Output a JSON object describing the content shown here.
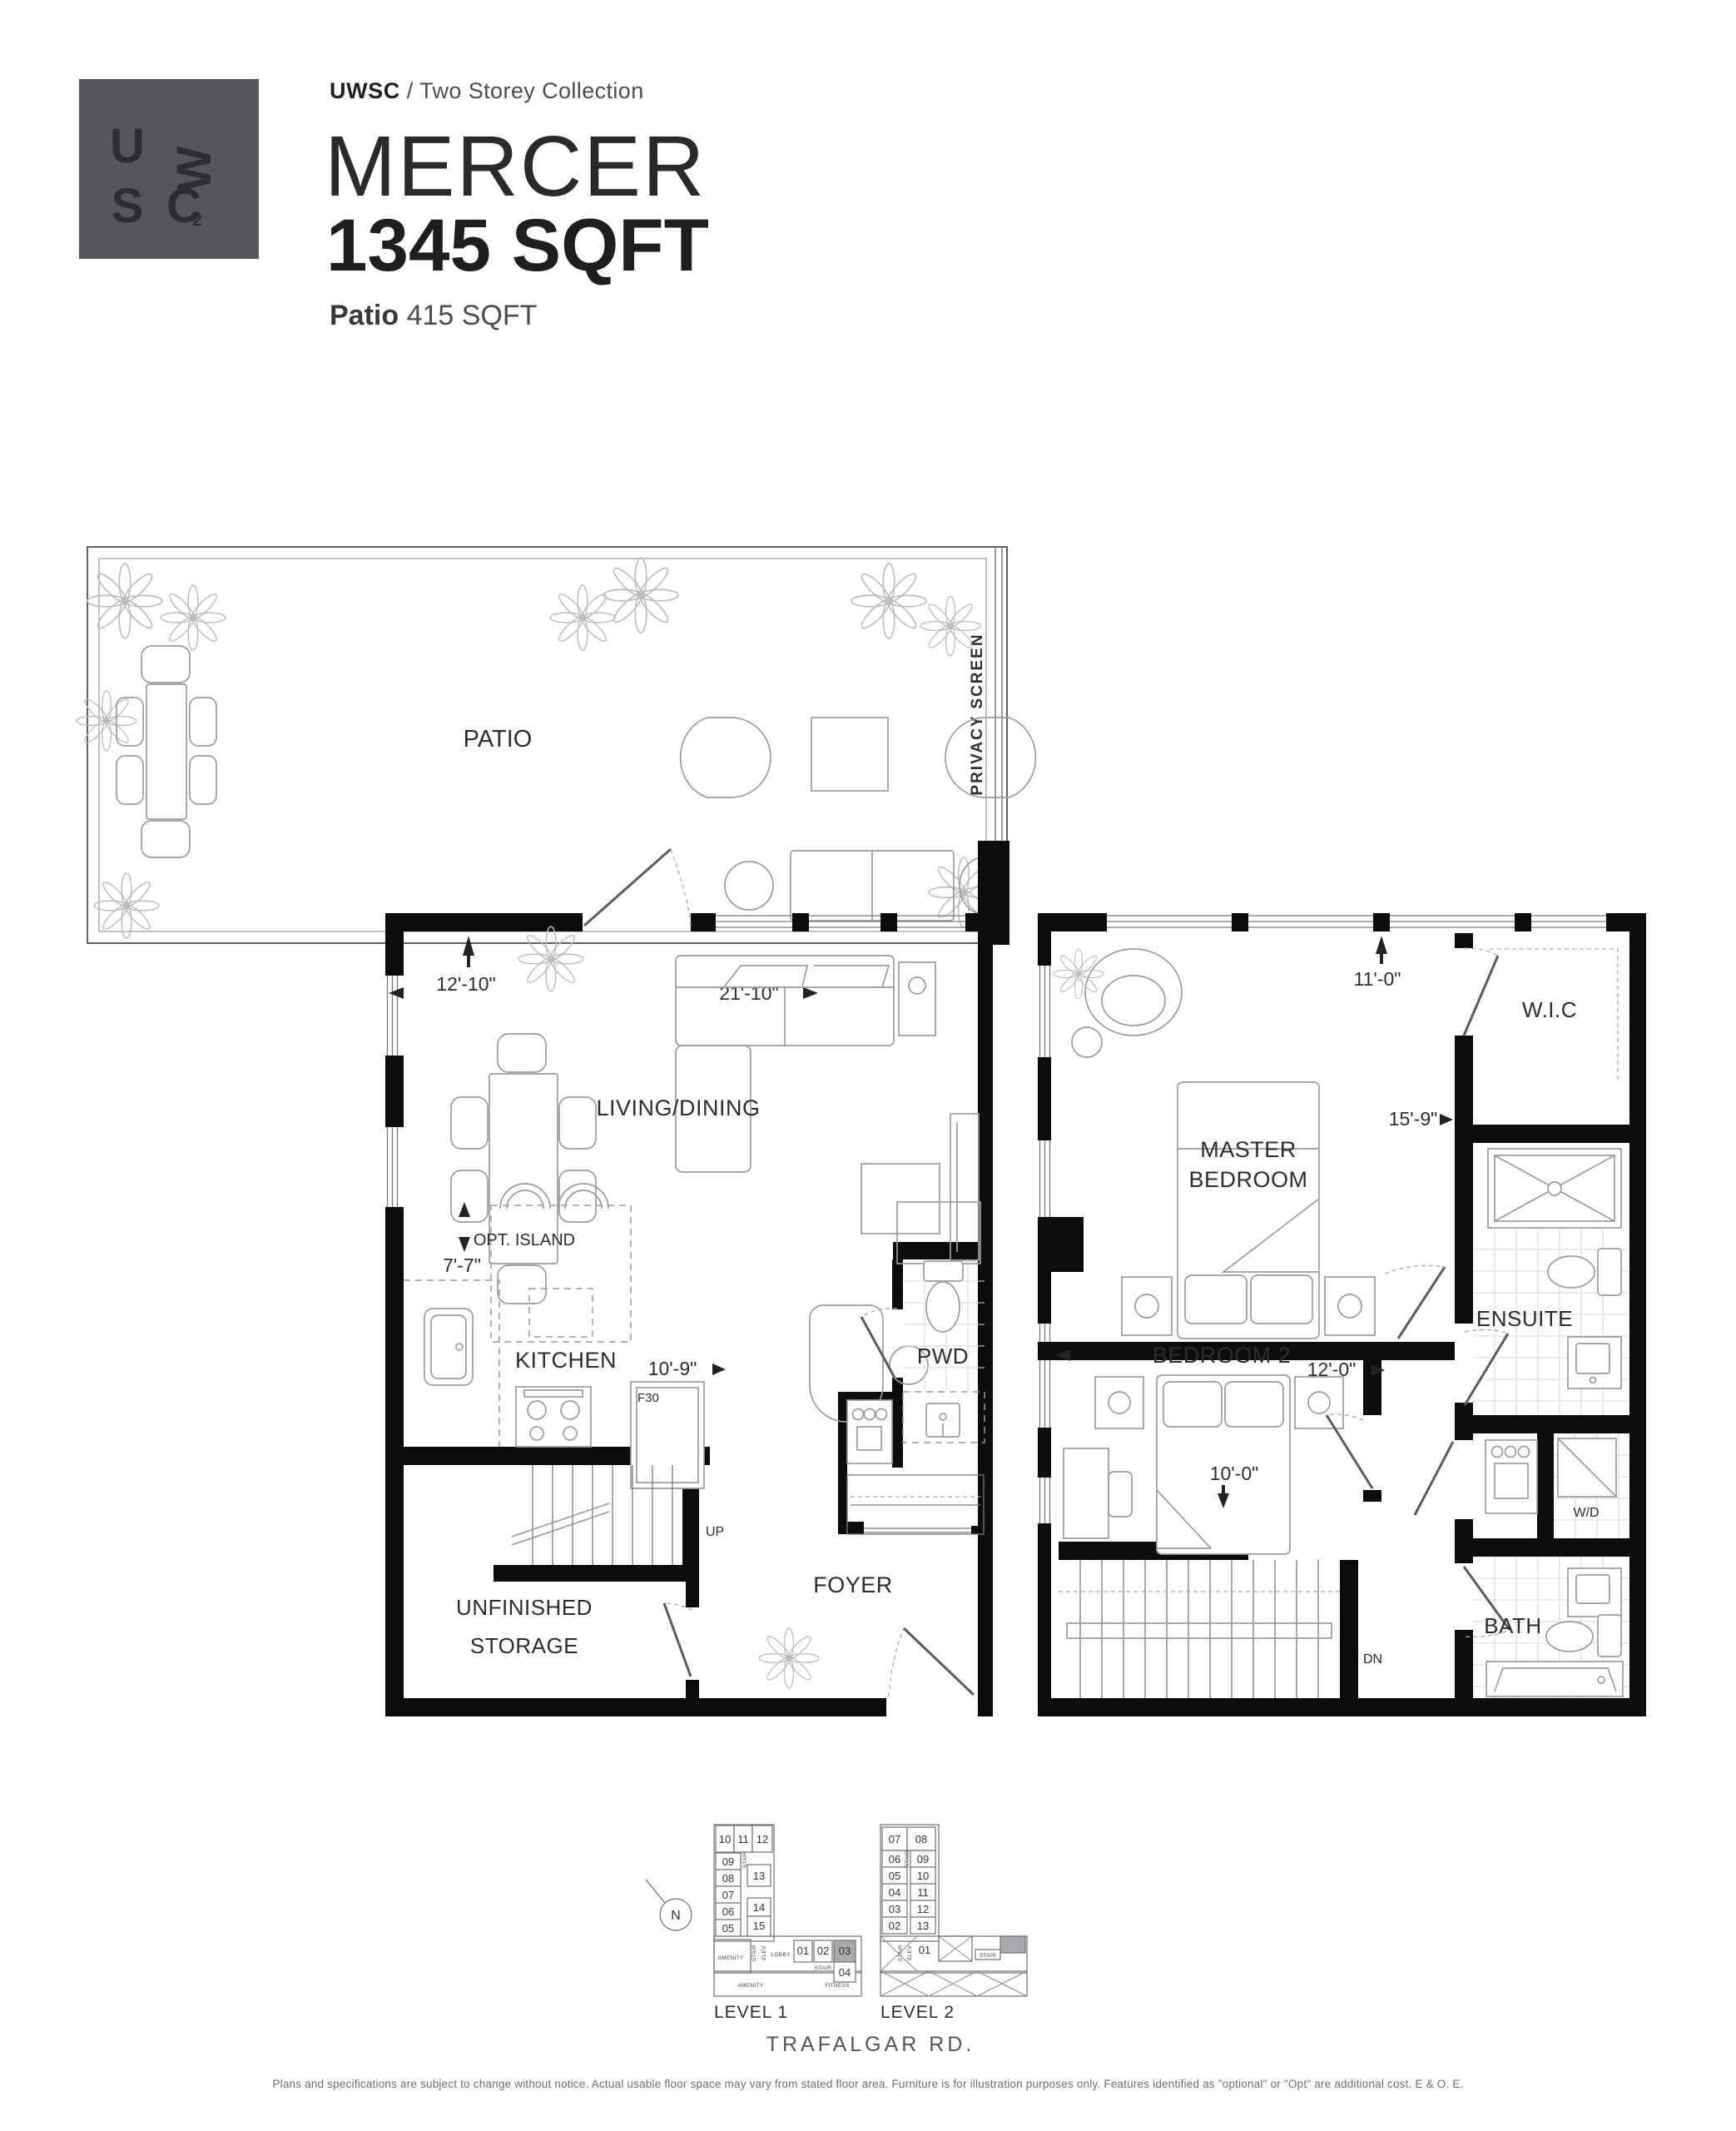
{
  "colors": {
    "logo_bg": "#55565a",
    "wall": "#0c0c0c",
    "highlight": "#a7a9ac",
    "furniture": "#9c9c9c",
    "text": "#2d2d2f",
    "muted": "#6e6e70"
  },
  "header": {
    "brand": "UWSC",
    "separator": "/",
    "collection": "Two Storey Collection",
    "plan_name": "MERCER",
    "plan_area": "1345 SQFT",
    "patio_label": "Patio",
    "patio_area": "415 SQFT"
  },
  "logo": {
    "u": "U",
    "w": "W",
    "s": "S",
    "c": "C",
    "two": "2"
  },
  "l1": {
    "patio": "PATIO",
    "privacy": "PRIVACY SCREEN",
    "living": "LIVING/DINING",
    "kitchen": "KITCHEN",
    "island": "OPT. ISLAND",
    "pwd": "PWD",
    "foyer": "FOYER",
    "storage1": "UNFINISHED",
    "storage2": "STORAGE",
    "up": "UP",
    "fridge": "F30",
    "d_entry": "12'-10\"",
    "d_depth": "21'-10\"",
    "d_kw": "7'-7\"",
    "d_kl": "10'-9\""
  },
  "l2": {
    "master1": "MASTER",
    "master2": "BEDROOM",
    "wic": "W.I.C",
    "ensuite": "ENSUITE",
    "bed2": "BEDROOM 2",
    "bath": "BATH",
    "wd": "W/D",
    "dn": "DN",
    "d_mw": "11'-0\"",
    "d_ml": "15'-9\"",
    "d_b2w": "12'-0\"",
    "d_b2l": "10'-0\""
  },
  "kp": {
    "north": "N",
    "street": "TRAFALGAR RD.",
    "l1": {
      "label": "LEVEL 1",
      "top": [
        "10",
        "11",
        "12"
      ],
      "left": [
        "09",
        "08",
        "07",
        "06",
        "05"
      ],
      "mid": [
        "13",
        "14",
        "15"
      ],
      "row": [
        "01",
        "02",
        "03",
        "04"
      ],
      "stair": "STAIR",
      "elev": "ELEV",
      "amenity": "AMENITY",
      "lobby": "LOBBY",
      "fitness": "FITNESS"
    },
    "l2": {
      "label": "LEVEL 2",
      "top": [
        "07",
        "08"
      ],
      "left": [
        "06",
        "05",
        "04",
        "03",
        "02"
      ],
      "right": [
        "09",
        "10",
        "11",
        "12",
        "13"
      ],
      "unit01": "01",
      "stair": "STAIR",
      "elev": "ELEV"
    }
  },
  "footer": {
    "disclaimer": "Plans and specifications are subject to change without notice. Actual usable floor space may vary from stated floor area. Furniture is for illustration purposes only. Features identified as \"optional\" or \"Opt\" are additional cost. E & O. E."
  }
}
